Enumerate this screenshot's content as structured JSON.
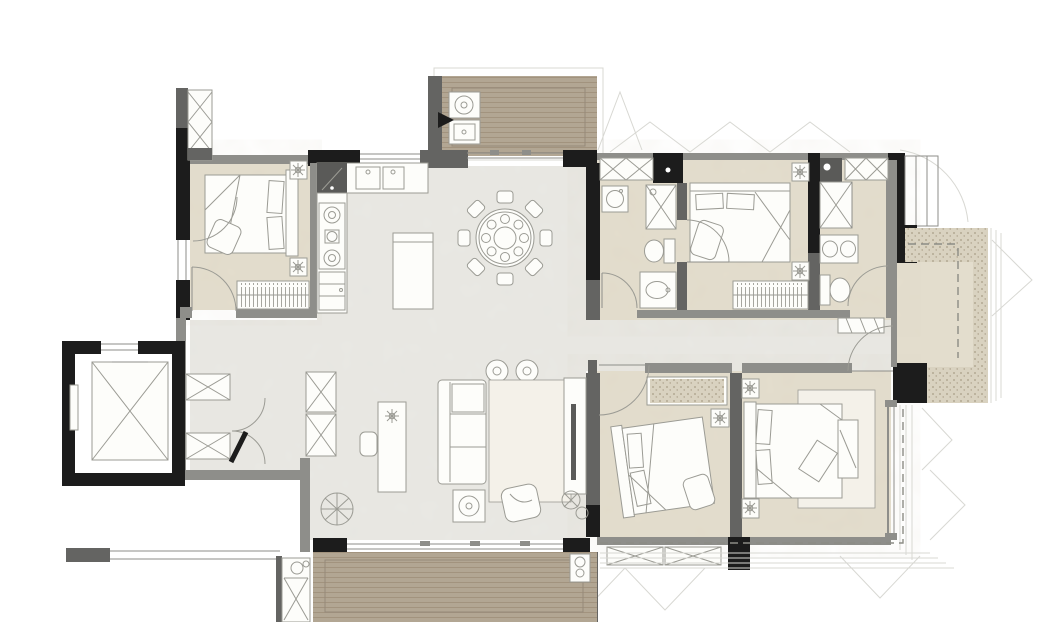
{
  "colors": {
    "paper": "#ffffff",
    "wall-black": "#1c1c1c",
    "wall-dark": "#646462",
    "wall-gray": "#8e8e8a",
    "floor-marble": "#e9e8e3",
    "floor-beige": "#e3ddcd",
    "deck-wood": "#b2a693",
    "deck-stripe": "#a2937e",
    "deck-edge": "#95897a",
    "stipple-bg": "#d9d2c0",
    "stipple-dot": "#a89c86",
    "furn-fill": "#fdfdfa",
    "furn-stroke": "#9b9b94",
    "rug-fill": "#f4f1e9",
    "hatch": "#8f8f88",
    "dash": "#8c8c85",
    "faint": "#d8d8d3",
    "appliance-dark": "#5a5a58"
  },
  "plan": {
    "type": "residential-apartment-floor-plan",
    "style": "rendered interior-design plan, no text labels visible",
    "rooms": [
      {
        "name": "service-balcony",
        "floor": "wood-deck",
        "position": "top-center"
      },
      {
        "name": "kitchen",
        "floor": "marble",
        "position": "top-center-left"
      },
      {
        "name": "dining-area",
        "floor": "marble",
        "position": "center-top"
      },
      {
        "name": "living-room",
        "floor": "marble",
        "position": "center-bottom"
      },
      {
        "name": "entry-foyer",
        "floor": "marble",
        "position": "left-bottom"
      },
      {
        "name": "hallway",
        "floor": "marble",
        "position": "center"
      },
      {
        "name": "bedroom-1",
        "floor": "beige",
        "position": "top-left"
      },
      {
        "name": "bedroom-2",
        "floor": "beige",
        "position": "top-right-center"
      },
      {
        "name": "bathroom-1",
        "floor": "beige",
        "position": "top-center-right"
      },
      {
        "name": "master-bathroom",
        "floor": "beige",
        "position": "top-right"
      },
      {
        "name": "bedroom-3",
        "floor": "beige",
        "position": "bottom-center-right"
      },
      {
        "name": "master-bedroom",
        "floor": "beige",
        "position": "bottom-right"
      },
      {
        "name": "bay-window",
        "floor": "beige",
        "position": "right"
      },
      {
        "name": "living-balcony",
        "floor": "wood-deck",
        "position": "bottom-center"
      },
      {
        "name": "elevator-lobby",
        "floor": "none",
        "position": "left-bottom"
      },
      {
        "name": "utility-shafts",
        "floor": "none",
        "position": "top-left and bottom-left"
      }
    ],
    "furniture": [
      "round-dining-table-with-8-chairs",
      "kitchen-island",
      "cooktop-3-burners",
      "double-basin-kitchen-sink",
      "washing-machine",
      "laundry-sink",
      "sofa",
      "coffee-table",
      "lounge-chair",
      "round-side-tables",
      "tv-console",
      "writing-desk",
      "desk-chair",
      "potted-plants",
      "area-rugs",
      "double-bed-bedroom-1",
      "double-bed-bedroom-2",
      "double-bed-bedroom-3",
      "double-bed-master",
      "nightstands-with-plants",
      "wardrobes",
      "toilets",
      "vanity-sinks",
      "shower",
      "bench",
      "shoe-cabinets",
      "elevator-car",
      "entry-double-door"
    ]
  }
}
